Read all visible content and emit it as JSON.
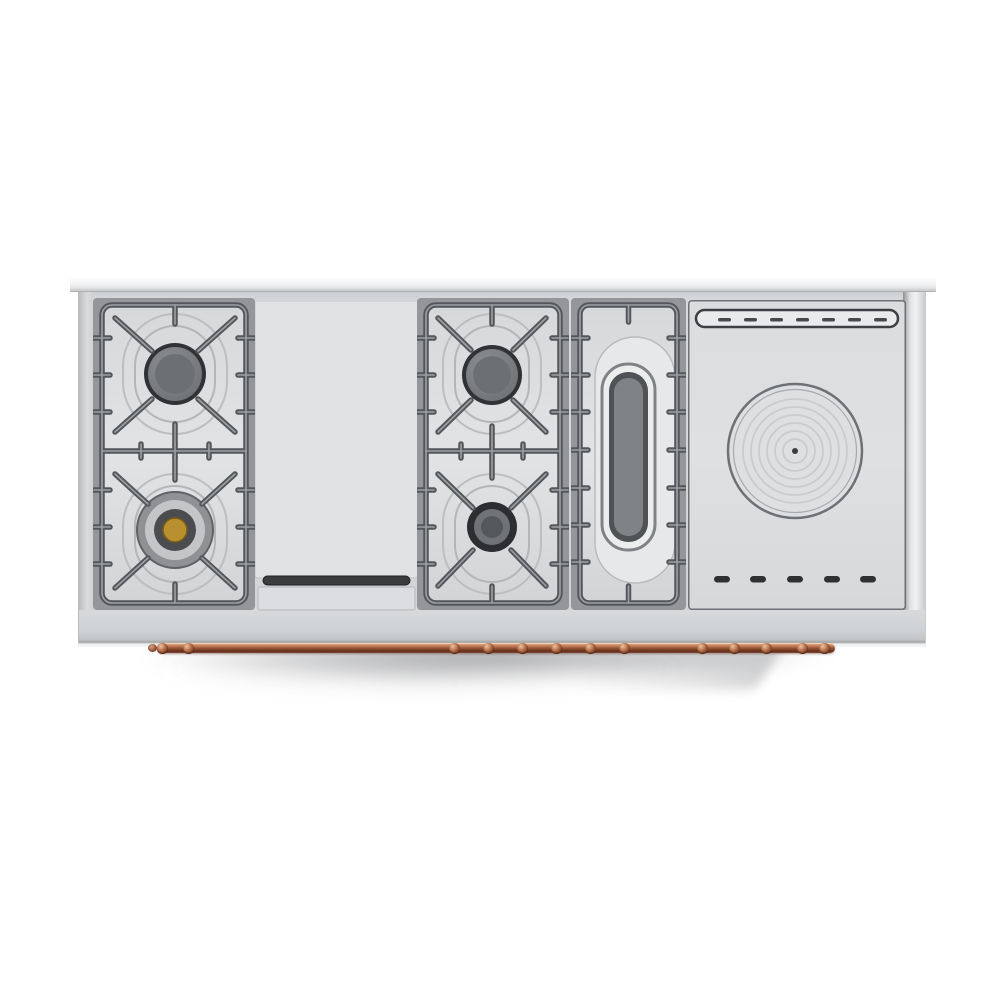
{
  "scene": {
    "background_color": "#ffffff",
    "subject": "Top-down product photo of a stainless steel professional range top",
    "shadow": "soft gray drop shadow cast below the front edge"
  },
  "appliance": {
    "type": "range-top",
    "finish": "brushed stainless steel",
    "sections": [
      {
        "name": "left burner section",
        "type": "gas-burner-pair",
        "burners": [
          {
            "position": "rear",
            "cap": "steel"
          },
          {
            "position": "front",
            "cap": "brass center"
          }
        ]
      },
      {
        "name": "griddle section",
        "type": "griddle",
        "features": [
          "smooth griddle plate",
          "grease trough",
          "front drip tray"
        ]
      },
      {
        "name": "center burner section",
        "type": "gas-burner-pair",
        "burners": [
          {
            "position": "rear",
            "cap": "steel"
          },
          {
            "position": "front",
            "cap": "steel"
          }
        ]
      },
      {
        "name": "oval burner section",
        "type": "french-oval-burner",
        "features": [
          "recessed oval well",
          "chrome oval ring",
          "cast grate frame"
        ]
      },
      {
        "name": "solid plate section",
        "type": "simmer-plate",
        "features": [
          "rear vent slot with dashes",
          "round plate with concentric rings and center cap",
          "five front vent slots"
        ]
      }
    ],
    "rail": {
      "material": "copper",
      "position": "front lower edge",
      "style": "linked towel rail"
    }
  },
  "counts": {
    "gas_burners": 4,
    "oval_burners": 1,
    "solid_plates": 1,
    "front_vent_slots": 5,
    "rear_slot_dashes": 7,
    "plate_rings": 6
  },
  "colors": {
    "steel_light": "#e2e3e5",
    "steel_mid": "#cfd1d4",
    "griddle_plate": "#e1e2e4",
    "tray": "#dcdde0",
    "trough": "#3a3c3e",
    "grate_dark": "#53565a",
    "grate_highlight": "#9da1a4",
    "well_frame": "#94969a",
    "burner_cap": "#7e8184",
    "burner_ring_dark": "#303235",
    "brass": "#b9902f",
    "oval_center": "#808386",
    "plate_ring": "#c9cbcd",
    "vent_dark": "#2e3032",
    "copper": "#a05a3a",
    "shadow": "#8a8b90"
  }
}
